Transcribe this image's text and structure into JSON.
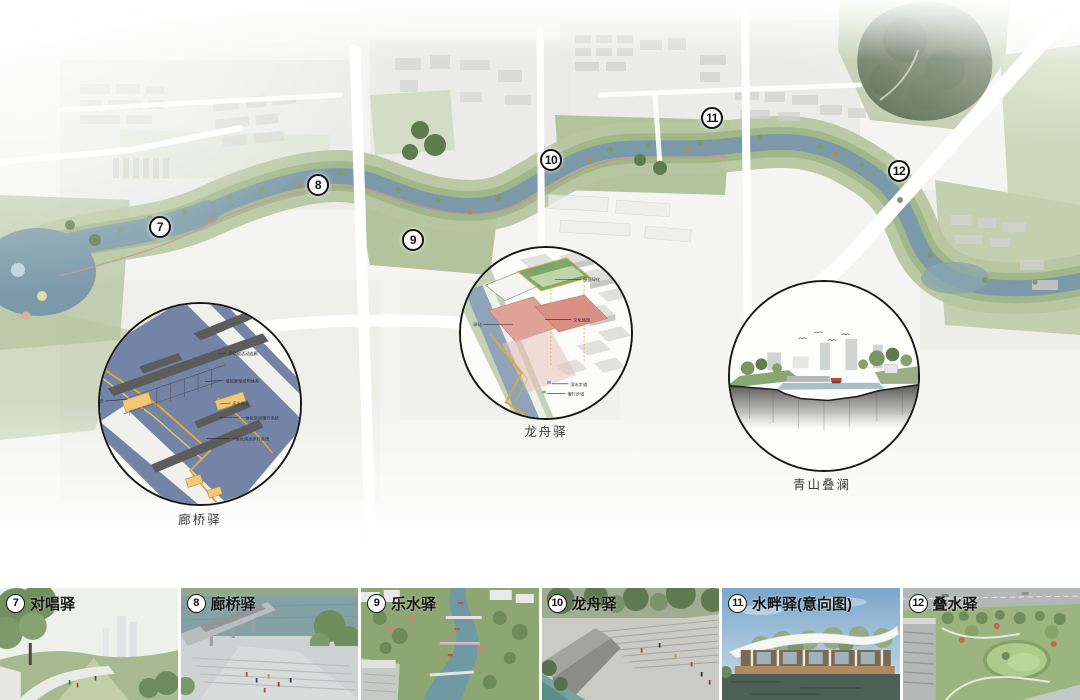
{
  "map": {
    "markers": [
      {
        "number": "7",
        "x": 160,
        "y": 227
      },
      {
        "number": "8",
        "x": 318,
        "y": 185
      },
      {
        "number": "9",
        "x": 413,
        "y": 240
      },
      {
        "number": "10",
        "x": 551,
        "y": 160
      },
      {
        "number": "11",
        "x": 712,
        "y": 118
      },
      {
        "number": "12",
        "x": 899,
        "y": 171
      }
    ]
  },
  "callouts": {
    "langqiao": {
      "label": "廊桥驿",
      "annotations": [
        {
          "text": "多功能活动连廊",
          "x1": 120,
          "y1": 51,
          "x2": 129,
          "y2": 50,
          "tx": 131,
          "ty": 52,
          "anchor": "start"
        },
        {
          "text": "低碳廊架结构体系",
          "x1": 107,
          "y1": 79,
          "x2": 126,
          "y2": 78,
          "tx": 128,
          "ty": 80,
          "anchor": "start"
        },
        {
          "text": "换乘平台",
          "x1": 6,
          "y1": 99,
          "x2": 28,
          "y2": 97,
          "tx": 4,
          "ty": 100,
          "anchor": "end"
        },
        {
          "text": "乐水驿站",
          "x1": 122,
          "y1": 102,
          "x2": 133,
          "y2": 101,
          "tx": 135,
          "ty": 103,
          "anchor": "start"
        },
        {
          "text": "一体化空间慢行系统",
          "x1": 122,
          "y1": 116,
          "x2": 142,
          "y2": 116,
          "tx": 144,
          "ty": 118,
          "anchor": "start"
        },
        {
          "text": "一体化滨水步行系统",
          "x1": 109,
          "y1": 137,
          "x2": 132,
          "y2": 137,
          "tx": 134,
          "ty": 139,
          "anchor": "start"
        }
      ]
    },
    "longzhou": {
      "label": "龙舟驿",
      "annotations": [
        {
          "text": "屋顶绿化",
          "x1": 96,
          "y1": 32,
          "x2": 123,
          "y2": 32,
          "tx": 125,
          "ty": 34,
          "anchor": "start"
        },
        {
          "text": "文化场馆",
          "x1": 86,
          "y1": 73,
          "x2": 113,
          "y2": 73,
          "tx": 115,
          "ty": 75,
          "anchor": "start"
        },
        {
          "text": "驿站",
          "x1": 23,
          "y1": 78,
          "x2": 53,
          "y2": 78,
          "tx": 21,
          "ty": 80,
          "anchor": "end"
        },
        {
          "text": "滨水步道",
          "x1": 93,
          "y1": 139,
          "x2": 110,
          "y2": 139,
          "tx": 112,
          "ty": 141,
          "anchor": "start"
        },
        {
          "text": "慢行步道",
          "x1": 88,
          "y1": 149,
          "x2": 107,
          "y2": 149,
          "tx": 109,
          "ty": 151,
          "anchor": "start"
        }
      ]
    },
    "qingshan": {
      "label": "青山叠澜"
    }
  },
  "thumbnails": [
    {
      "number": "7",
      "label": "对唱驿"
    },
    {
      "number": "8",
      "label": "廊桥驿"
    },
    {
      "number": "9",
      "label": "乐水驿"
    },
    {
      "number": "10",
      "label": "龙舟驿"
    },
    {
      "number": "11",
      "label": "水畔驿(意向图)"
    },
    {
      "number": "12",
      "label": "叠水驿"
    }
  ],
  "colors": {
    "river": "#7b99a9",
    "bank_green": "#a9bc90",
    "forest_green": "#63745a",
    "path_red": "#c98f93",
    "marker_ring": "#141414",
    "callout_ring": "#161616"
  }
}
